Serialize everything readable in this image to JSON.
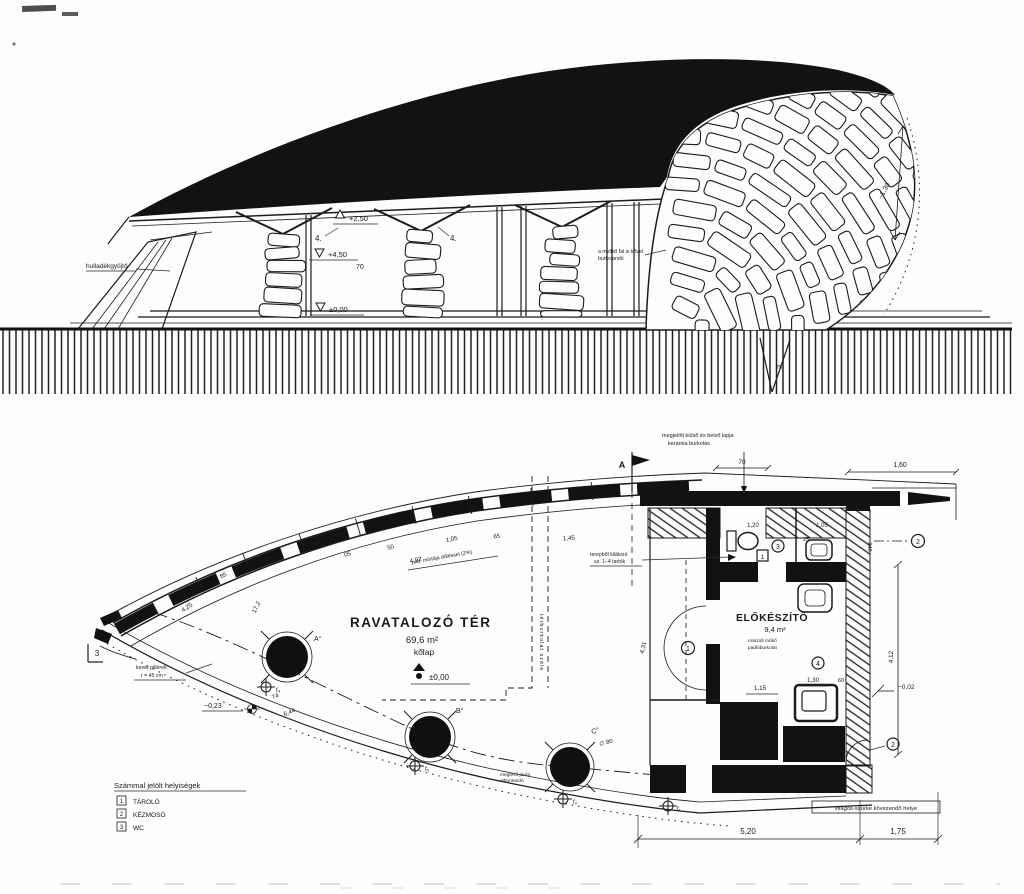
{
  "colors": {
    "ink": "#1b1b1b",
    "paper": "#fdfdfb"
  },
  "elevation": {
    "waste_label": "hulladékgyűjtő",
    "level_ridge": "+2,50",
    "level_canopy": "+4,50",
    "level_zero": "±0,00",
    "strut_left": "4.",
    "strut_right": "4.",
    "dim_beam": "70",
    "wall_note_1": "a mellső fal is kővel",
    "wall_note_2": "burkolandó",
    "dim_arc": "~1,30",
    "slope_mark": "75"
  },
  "plan": {
    "section_marker": "A",
    "main_room": {
      "name": "RAVATALOZÓ TÉR",
      "area": "69,6 m²",
      "floor": "kőlap",
      "level": "±0,00"
    },
    "prep_room": {
      "name": "ELŐKÉSZÍTŐ",
      "area": "9,4 m²",
      "note_1": "csiszolt műkő",
      "note_2": "padlóburkolat"
    },
    "top_note_1": "megjelölt külső és belső lapja",
    "top_note_2": "kerámia burkolás",
    "supports_note_1": "terepből kilátszó",
    "supports_note_2": "sz. 1–4 tartók",
    "floor_note": "pad. mintája dőléssel (2%)",
    "pillar_note_1": "kerek pillérek",
    "pillar_note_2": "r = 45 cm",
    "paving_note": "térburkolat széle",
    "demolish_note_1": "meglévő járda",
    "demolish_note_2": "elbontandó",
    "gray_paving_note": "világos-szürke kövezendő helye",
    "pillars": {
      "a": "A°",
      "b": "B°",
      "c": "C°",
      "dia": "∅ 80"
    },
    "markers": {
      "f1": "f₁",
      "f2": "f₂",
      "f3": "f₅",
      "f4": "f₄"
    },
    "room_numbers": {
      "n1": "1",
      "n2": "2",
      "n2b": "2",
      "n3": "3",
      "n4": "4",
      "box1": "1"
    },
    "levels": {
      "m023": "−0,23",
      "m002": "−0,02"
    },
    "dims": {
      "d3": "3",
      "d85": "85",
      "d05a": "05",
      "d185": "1,85",
      "d05b": "05",
      "d50": "50",
      "d492": "4,92",
      "d105a": "1,05",
      "d65": "65",
      "d145": "1,45",
      "d120": "1,20",
      "d105b": "1,05",
      "d25": "25",
      "d240": "240",
      "d70": "70",
      "d160": "1,60",
      "d425": "4,25",
      "d172": "17,2",
      "d644": "6,44",
      "d74": "74",
      "d115": "1,15",
      "d130": "1,30",
      "d60": "60",
      "d431": "4,31",
      "d412": "4,12",
      "d520": "5,20",
      "d175": "1,75"
    }
  },
  "legend": {
    "title": "Számmal jelölt helyiségek",
    "items": [
      {
        "num": "1",
        "label": "TÁROLÓ"
      },
      {
        "num": "2",
        "label": "KÉZMOSÓ"
      },
      {
        "num": "3",
        "label": "WC"
      }
    ]
  }
}
